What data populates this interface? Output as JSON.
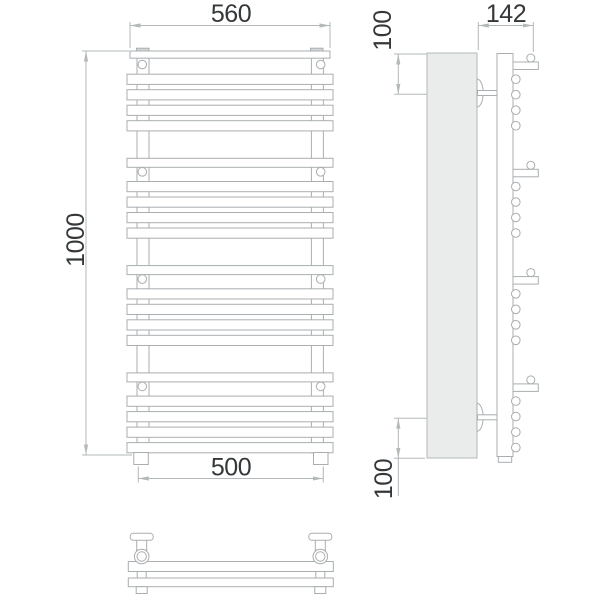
{
  "drawing": {
    "type": "technical-drawing",
    "subject": "wall-mounted towel rail radiator, three orthographic views"
  },
  "colors": {
    "line": "#a9aeb0",
    "dim": "#b3b8ba",
    "text": "#35383a",
    "panel_fill": "#eaebeb",
    "panel_stroke": "#b4b8ba",
    "cap_fill": "#d4d7d8"
  },
  "dimensions": {
    "front_top_width": "560",
    "front_height": "1000",
    "front_bottom_width": "500",
    "side_depth": "142",
    "side_top_bracket_offset": "100",
    "side_bottom_bracket_offset": "100"
  }
}
